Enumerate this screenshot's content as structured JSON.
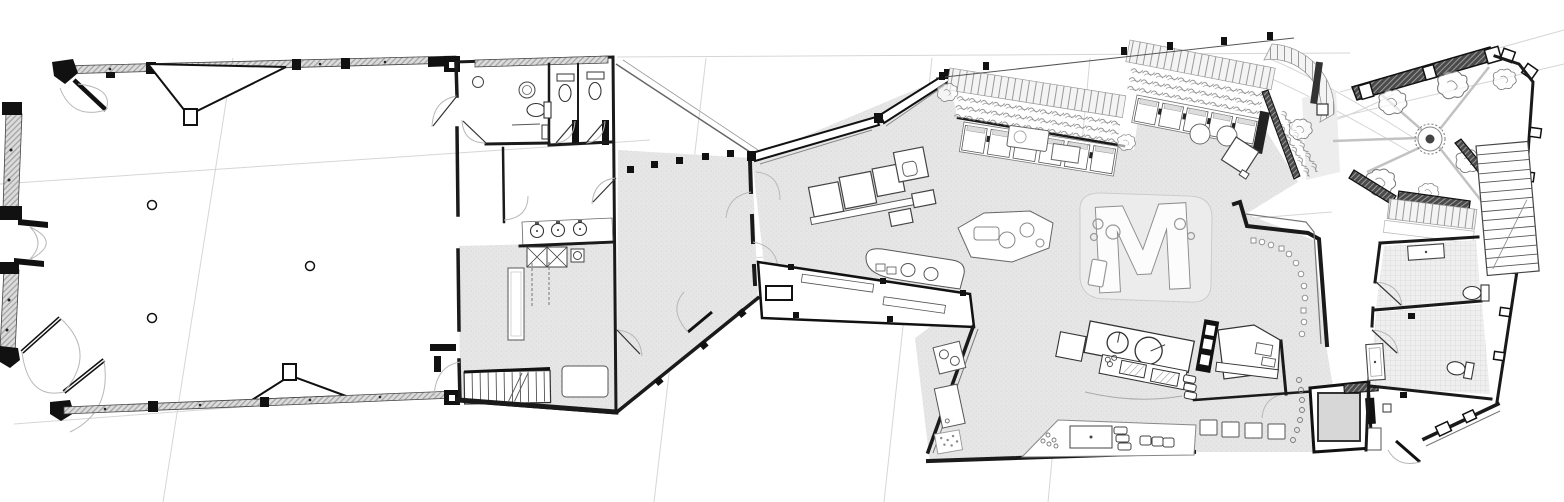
{
  "page": {
    "title": "Architectural ground floor plan"
  },
  "plan": {
    "m_sculpture_label": "M",
    "palette": {
      "paper": "#ffffff",
      "wall_ink": "#1a1a1a",
      "mid_line": "#555555",
      "light_line": "#b8b8b8",
      "floor_gray": "#e6e6e6",
      "bench_dark": "#4a4a4a",
      "glazing_gray": "#dcdcdc"
    },
    "areas": [
      {
        "id": "main-hall"
      },
      {
        "id": "service-core-restrooms"
      },
      {
        "id": "entry-lobby"
      },
      {
        "id": "central-pavilion"
      },
      {
        "id": "cafe-booth-terrace"
      },
      {
        "id": "kitchen-bar"
      },
      {
        "id": "m-sculpture"
      },
      {
        "id": "garden-court"
      },
      {
        "id": "garden-restrooms"
      },
      {
        "id": "garden-stairs"
      }
    ]
  }
}
